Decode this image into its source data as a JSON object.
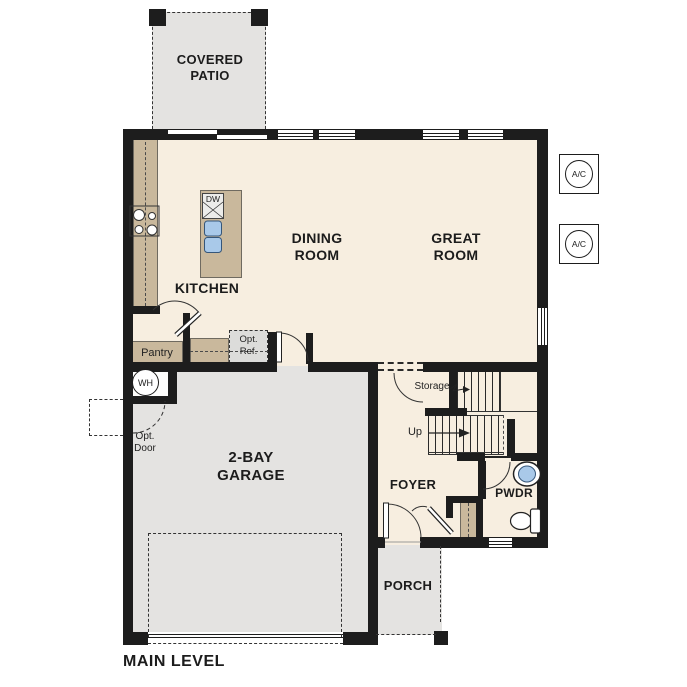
{
  "plan_title": "MAIN LEVEL",
  "rooms": {
    "covered_patio": {
      "label": "COVERED PATIO"
    },
    "kitchen": {
      "label": "KITCHEN"
    },
    "dining_room": {
      "label": "DINING ROOM"
    },
    "great_room": {
      "label": "GREAT ROOM"
    },
    "garage": {
      "label": "2-BAY GARAGE"
    },
    "foyer": {
      "label": "FOYER"
    },
    "porch": {
      "label": "PORCH"
    },
    "powder_room": {
      "label": "PWDR"
    },
    "pantry": {
      "label": "Pantry"
    }
  },
  "annotations": {
    "storage": "Storage",
    "up": "Up",
    "opt_ref": "Opt. Ref.",
    "opt_door": "Opt. Door",
    "water_heater": "WH",
    "dishwasher": "DW",
    "ac_unit": "A/C"
  },
  "colors": {
    "floor_cream": "#f7eee0",
    "concrete_gray": "#e4e3e1",
    "counter_tan": "#c9b89c",
    "wall_black": "#1d1d1d",
    "fixture_blue": "#a9c9e9"
  }
}
